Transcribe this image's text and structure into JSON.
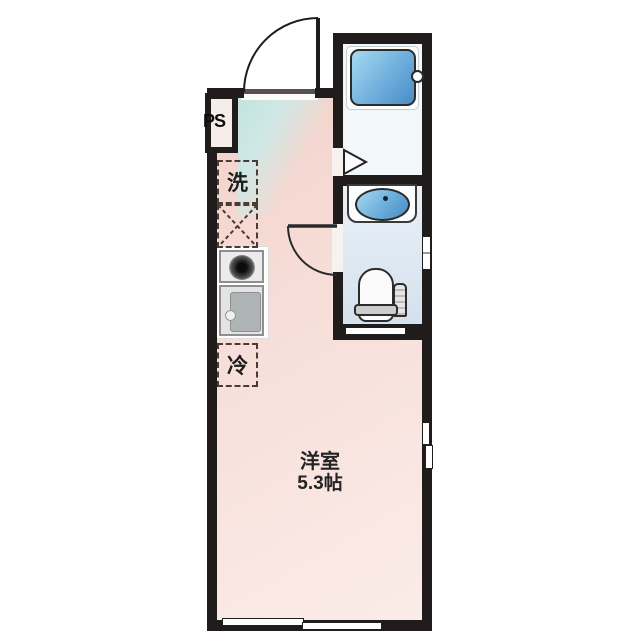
{
  "plan": {
    "labels": {
      "pipe_space": "PS",
      "washer": "洗",
      "fridge": "冷",
      "room_name": "洋室",
      "room_size": "5.3帖"
    },
    "fixtures": [
      "entrance-door",
      "bathtub",
      "wash-basin",
      "toilet",
      "kitchen-stove",
      "kitchen-sink",
      "washing-machine-space",
      "refrigerator-space",
      "pipe-space",
      "window"
    ]
  },
  "colors": {
    "wall": "#201c1b",
    "pink-a": "#f2d2cb",
    "pink-b": "#fbece9",
    "teal-a": "#c3e2de",
    "water-a": "#a6d9f2",
    "water-b": "#4a8cc4",
    "bath-floor": "#f2f7f9",
    "dash": "#4b3b37"
  }
}
